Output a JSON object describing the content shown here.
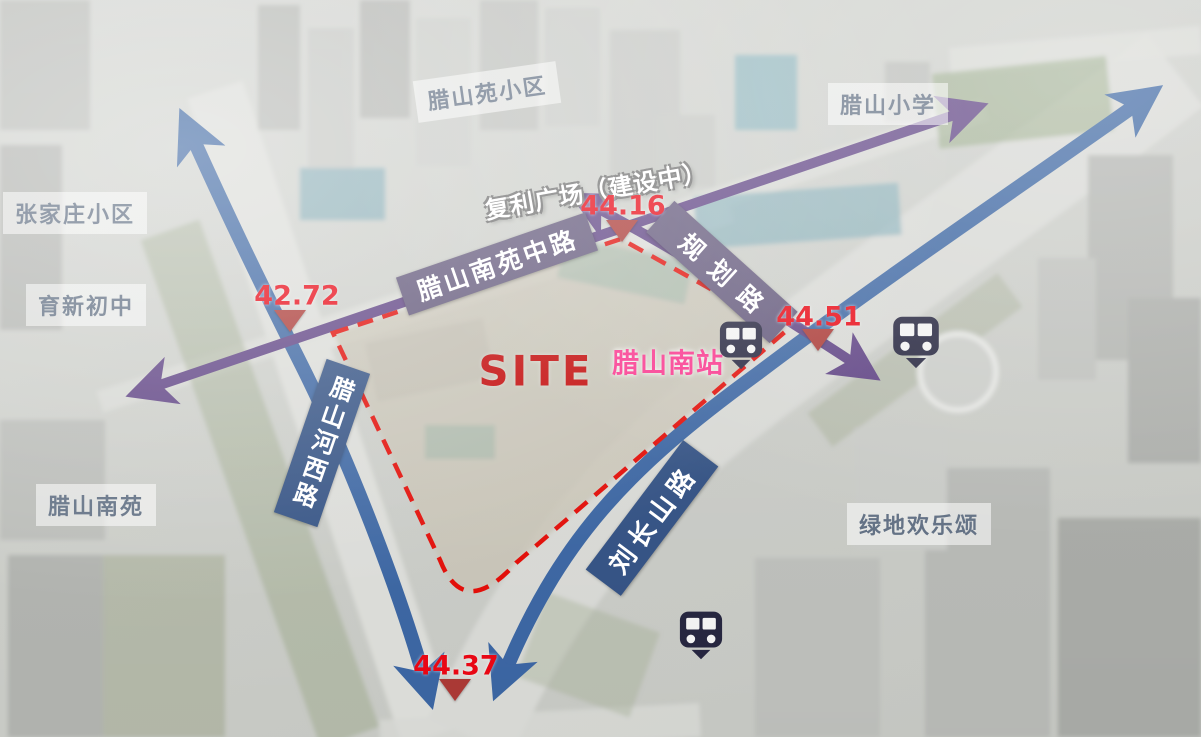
{
  "area_labels": {
    "lashanyuan_xiaoqu": "腊山苑小区",
    "lashan_xiaoxue": "腊山小学",
    "zhangjiazhuang_xiaoqu": "张家庄小区",
    "yuxin_chuzhong": "育新初中",
    "fuli_guangchang": "复利广场（建设中）",
    "lashan_nanyuan": "腊山南苑",
    "lvdi_huanlesong": "绿地欢乐颂"
  },
  "roads": {
    "lashan_nanyuan_zhonglu": "腊山南苑中路",
    "guihua_lu": "规划路",
    "lashan_hexi_lu": "腊山河西路",
    "liuchangshan_lu": "刘长山路"
  },
  "site": {
    "label": "SITE",
    "station_label": "腊山南站"
  },
  "elevations": {
    "north": "44.16",
    "west": "42.72",
    "east": "44.51",
    "south": "44.37"
  },
  "icons": {
    "metro": "metro-station-icon"
  },
  "colors": {
    "road_banner_blue": "#2e4d80",
    "road_banner_purple": "#5e5377",
    "axis_arrow_purple": "#5a3d80",
    "road_arrow_blue": "#36619f",
    "site_boundary_red": "#e10600",
    "elevation_red": "#e8000d",
    "station_pink": "#fa2f8a",
    "site_text_red": "#c00000",
    "metro_icon_dark": "#20203a",
    "area_label_text": "#5d6c80"
  }
}
